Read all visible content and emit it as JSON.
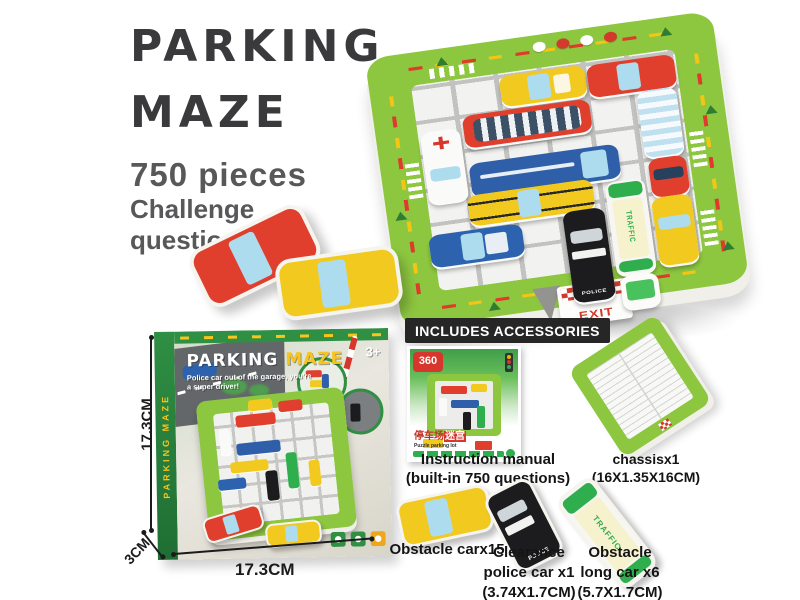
{
  "title": {
    "line1": "PARKING",
    "line2": "MAZE",
    "pieces": "750 pieces",
    "challenge_line1": "Challenge",
    "challenge_line2": "questions"
  },
  "board": {
    "exit_label": "EXIT",
    "traffic_label": "TRAFFIC",
    "police_label": "POLICE"
  },
  "box": {
    "title_word1": "PARKING ",
    "title_word2": "MAZE",
    "subtitle_line1": "Police car out of the garage, you're",
    "subtitle_line2": "a super driver!",
    "age_badge": "3+",
    "spine_text": "PARKING MAZE",
    "exit_label": "EXIT"
  },
  "dimensions": {
    "height": "17.3CM",
    "width": "17.3CM",
    "depth": "3CM"
  },
  "accessories": {
    "header": "INCLUDES ACCESSORIES",
    "manual": {
      "badge": "360",
      "cn_title": "停车场",
      "cn_title_highlight": "迷宫",
      "en_subtitle": "Puzzle parking lot",
      "caption_line1": "Instruction manual",
      "caption_line2": "(built-in 750 questions)"
    },
    "chassis": {
      "caption_line1": "chassisx1",
      "caption_line2": "(16X1.35X16CM)"
    },
    "obstacle_car": {
      "caption": "Obstacle carx15"
    },
    "police_car": {
      "caption_line1": "Clearance",
      "caption_line2": "police car x1",
      "caption_line3": "(3.74X1.7CM)",
      "label": "POLICE"
    },
    "long_car": {
      "caption_line1": "Obstacle",
      "caption_line2": "long car x6",
      "caption_line3": "(5.7X1.7CM)",
      "label": "TRAFFIC"
    }
  },
  "colors": {
    "board_green": "#8dc63f",
    "box_green": "#2f8f43",
    "accent_red": "#df3f2c",
    "accent_yellow": "#f2c91f",
    "accent_blue": "#2e5fa8",
    "traffic_green": "#2fae4e",
    "banner_bg": "#262626",
    "title_text": "#3a3a3c",
    "subtitle_text": "#58585a"
  }
}
